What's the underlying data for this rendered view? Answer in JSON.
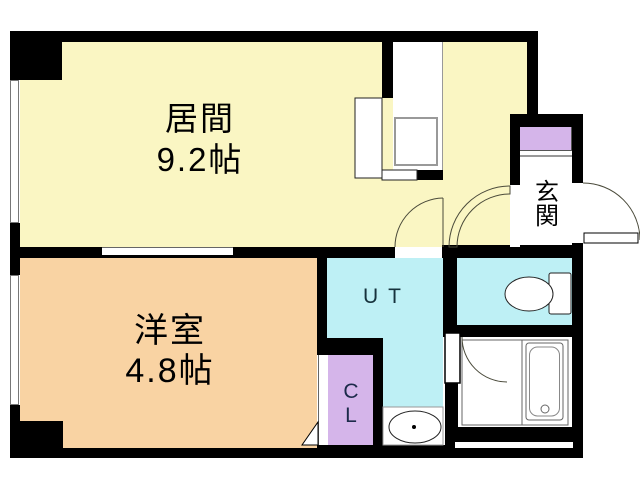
{
  "plan": {
    "type": "apartment-floor-plan",
    "rooms": {
      "living": {
        "name": "居間",
        "size": "9.2帖",
        "color": "#FAF6C3"
      },
      "western": {
        "name": "洋室",
        "size": "4.8帖",
        "color": "#F9D3A3"
      },
      "utility": {
        "label": "UT",
        "color": "#BEF0F5"
      },
      "toilet": {
        "color": "#BEF0F5"
      },
      "bathroom": {
        "color": "#FFFFFF"
      },
      "closet": {
        "label_top": "C",
        "label_bottom": "L",
        "color": "#D5B5EA"
      },
      "entrance": {
        "label_top": "玄",
        "label_bottom": "関",
        "shoebox_color": "#D5B5EA"
      }
    },
    "colors": {
      "wall": "#000000",
      "background": "#FFFFFF",
      "door_line": "#4a4a3a"
    }
  }
}
